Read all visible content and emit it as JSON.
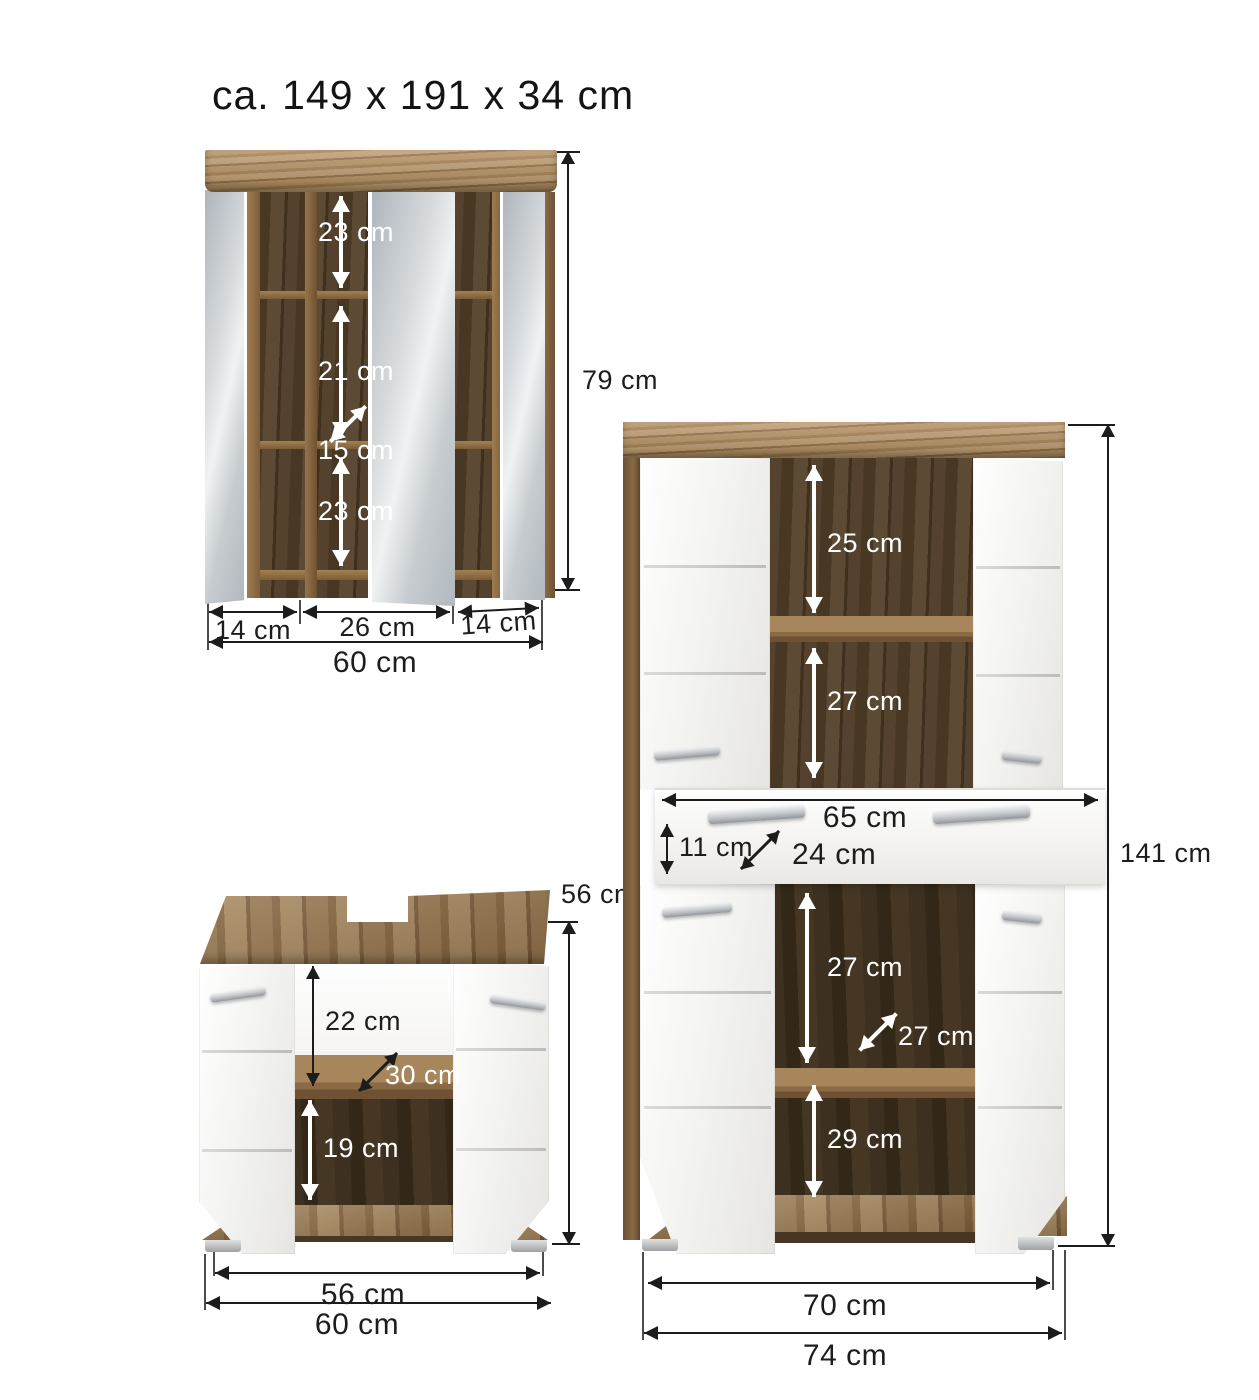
{
  "title": "ca. 149 x 191 x 34 cm",
  "colors": {
    "wood": "#a9885c",
    "dark_wood": "#4a3a28",
    "mirror": "#d6dadd",
    "door_white": "#f4f4f2",
    "dimension_line": "#1c1c1c",
    "white_label": "#ffffff"
  },
  "mirror_cabinet": {
    "name": "mirror cabinet",
    "height_label": "79 cm",
    "shelf_top_label": "23 cm",
    "shelf_middle_label": "21 cm",
    "depth_label": "15 cm",
    "shelf_bottom_label": "23 cm",
    "width_left_label": "14 cm",
    "width_center_label": "26 cm",
    "width_right_label": "14 cm",
    "width_total_label": "60 cm"
  },
  "vanity_cabinet": {
    "name": "washbasin vanity cabinet",
    "height_label": "56 cm",
    "upper_label": "22 cm",
    "depth_label": "30 cm",
    "lower_label": "19 cm",
    "width_inner_label": "56 cm",
    "width_total_label": "60 cm"
  },
  "tall_cabinet": {
    "name": "tall midi cabinet",
    "height_label": "141 cm",
    "shelf1_label": "25 cm",
    "shelf2_label": "27 cm",
    "drawer_width_label": "65 cm",
    "drawer_height_label": "11 cm",
    "drawer_depth_label": "24 cm",
    "shelf3_label": "27 cm",
    "depth_label": "27 cm",
    "shelf4_label": "29 cm",
    "width_inner_label": "70 cm",
    "width_total_label": "74 cm"
  }
}
